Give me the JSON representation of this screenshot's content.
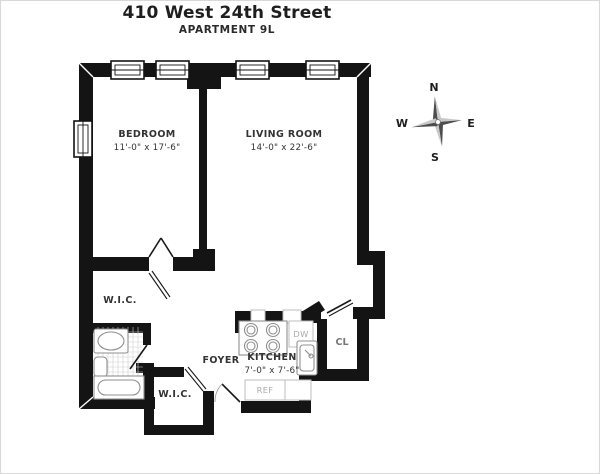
{
  "header": {
    "title": "410 West 24th Street",
    "subtitle": "APARTMENT 9L"
  },
  "rooms": {
    "bedroom": {
      "label": "BEDROOM",
      "dims": "11'-0\" x 17'-6\""
    },
    "living_room": {
      "label": "LIVING ROOM",
      "dims": "14'-0\" x 22'-6\""
    },
    "kitchen": {
      "label": "KITCHEN",
      "dims": "7'-0\" x 7'-6\""
    },
    "foyer": {
      "label": "FOYER"
    },
    "wic_upper": {
      "label": "W.I.C."
    },
    "wic_lower": {
      "label": "W.I.C."
    },
    "closet": {
      "label": "CL"
    }
  },
  "appliances": {
    "dishwasher": "DW",
    "refrigerator": "REF"
  },
  "compass": {
    "north": "N",
    "south": "S",
    "east": "E",
    "west": "W"
  },
  "colors": {
    "wall": "#141414",
    "fixture_outline": "#8f8f8f",
    "label": "#333333",
    "muted_label": "#a9a9a9",
    "compass_dark": "#4d4d4d",
    "compass_light": "#c9c9c9"
  }
}
